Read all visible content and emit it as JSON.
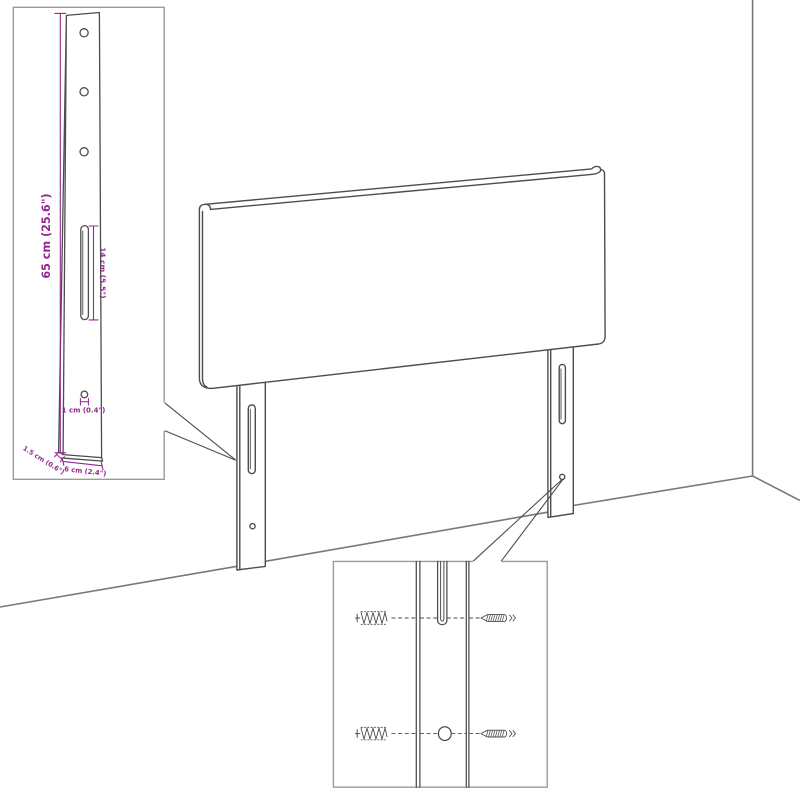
{
  "diagram": {
    "kind": "furniture-assembly-diagram",
    "subject": "headboard-with-mounting-legs",
    "background": "#ffffff",
    "line_color": "#4d4d4d",
    "wall_line_color": "#787878",
    "inset_border_color": "#9a9a9a",
    "dimension_color": "#92278f"
  },
  "inset_leg_dimensions": {
    "height_label": "65 cm (25.6\")",
    "slot_length_label": "14 cm (5.5\")",
    "hole_label": "1 cm (0.4\")",
    "thickness_label": "1.5 cm (0.6\")",
    "width_label": "6 cm (2.4\")"
  },
  "inset_mounting_detail": {
    "parts": [
      "wall-plug",
      "screw",
      "leg-slot",
      "leg-hole"
    ]
  }
}
